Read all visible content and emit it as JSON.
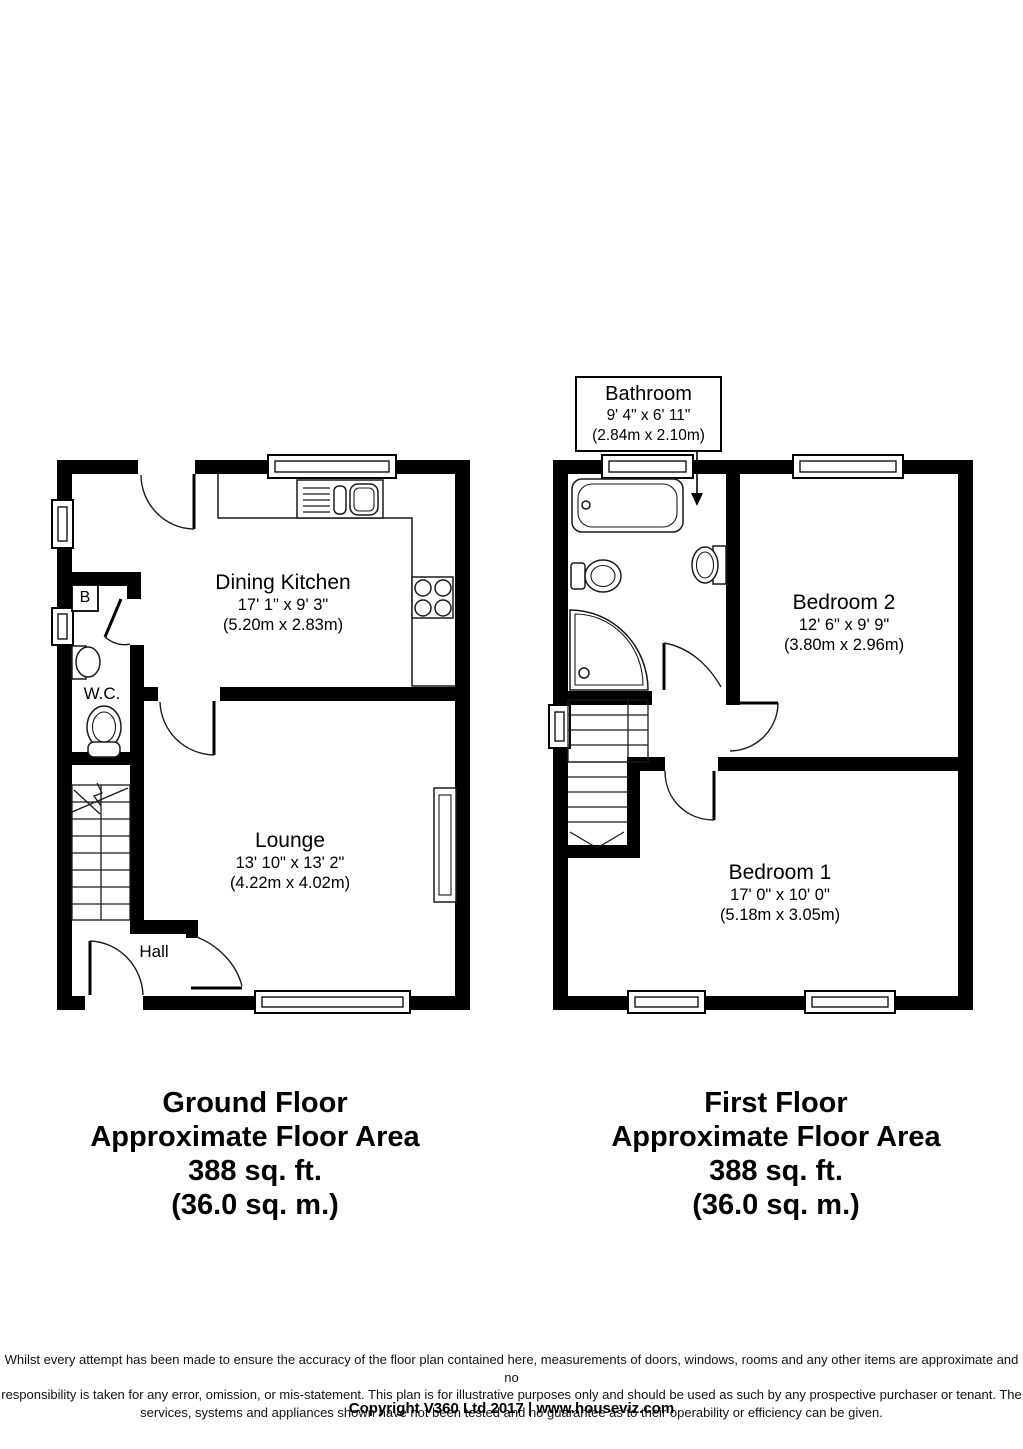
{
  "colors": {
    "wall": "#000000",
    "fixture_line": "#1a1a1a",
    "background": "#ffffff"
  },
  "ground_floor": {
    "rooms": {
      "dining_kitchen": {
        "name": "Dining Kitchen",
        "imperial": "17' 1\" x 9' 3\"",
        "metric": "(5.20m x 2.83m)"
      },
      "lounge": {
        "name": "Lounge",
        "imperial": "13' 10\" x 13' 2\"",
        "metric": "(4.22m x 4.02m)"
      },
      "wc": {
        "name": "W.C."
      },
      "hall": {
        "name": "Hall"
      },
      "boiler": {
        "name": "B"
      }
    },
    "caption": {
      "title": "Ground Floor",
      "subtitle": "Approximate Floor Area",
      "area_imperial": "388 sq. ft.",
      "area_metric": "(36.0 sq. m.)"
    }
  },
  "first_floor": {
    "rooms": {
      "bathroom": {
        "name": "Bathroom",
        "imperial": "9' 4\" x 6' 11\"",
        "metric": "(2.84m x 2.10m)"
      },
      "bedroom2": {
        "name": "Bedroom 2",
        "imperial": "12' 6\" x 9' 9\"",
        "metric": "(3.80m x 2.96m)"
      },
      "bedroom1": {
        "name": "Bedroom 1",
        "imperial": "17' 0\" x 10' 0\"",
        "metric": "(5.18m x 3.05m)"
      }
    },
    "caption": {
      "title": "First Floor",
      "subtitle": "Approximate Floor Area",
      "area_imperial": "388 sq. ft.",
      "area_metric": "(36.0 sq. m.)"
    }
  },
  "footer": {
    "disclaimer": [
      "Whilst every attempt has been made to ensure the accuracy of the floor plan contained here, measurements of doors, windows, rooms and any other items are approximate and no",
      "responsibility is taken for any error, omission, or mis-statement. This plan is for illustrative purposes only and should be used as such by any prospective purchaser or tenant. The",
      "services, systems and appliances shown have not been tested and no guarantee as to their operability or efficiency can be given."
    ],
    "copyright": "Copyright V360 Ltd 2017 | www.houseviz.com"
  }
}
